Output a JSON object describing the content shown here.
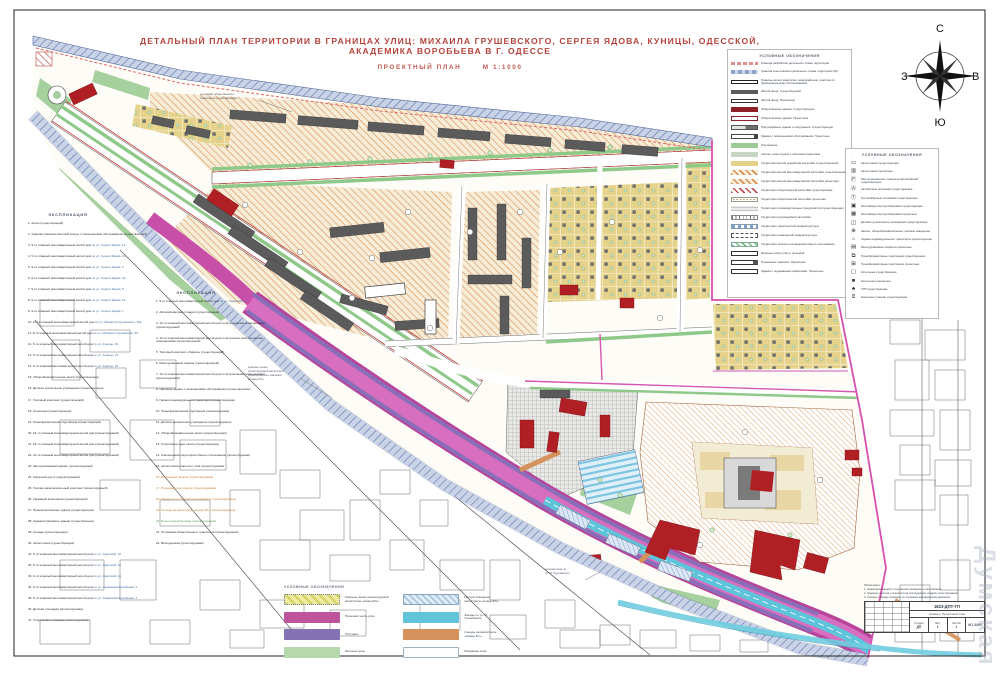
{
  "page": {
    "title": "ДЕТАЛЬНЫЙ ПЛАН ТЕРРИТОРИИ В ГРАНИЦАХ УЛИЦ: МИХАИЛА ГРУШЕВСКОГО, СЕРГЕЯ ЯДОВА, КУНИЦЫ, ОДЕССКОЙ, АКАДЕМИКА ВОРОБЬЕВА В Г. ОДЕССЕ",
    "subtitle": "ПРОЕКТНЫЙ ПЛАН",
    "scale": "М 1:1000",
    "watermark": "Думская"
  },
  "compass": {
    "north": "С",
    "south": "Ю",
    "west": "З",
    "east": "В"
  },
  "legend_main": {
    "header": "УСЛОВНЫЕ ОБОЗНАЧЕНИЯ",
    "items": [
      {
        "swatch": "sw-pinkline",
        "label": "Граница разработки детального плана территории"
      },
      {
        "swatch": "sw-blueband",
        "label": "Граница зоны влияния детального плана территории (М)"
      },
      {
        "swatch": "sw-outline-hatch",
        "label": "Границы жилых кварталов, микрорайонов, участков по функциональному использованию"
      },
      {
        "swatch": "sw-darkgray",
        "label": "Жилой фонд. Существующий"
      },
      {
        "swatch": "sw-whitebar",
        "label": "Жилой фонд. Проектный"
      },
      {
        "swatch": "sw-darkred",
        "label": "Общественные здания. Существующие"
      },
      {
        "swatch": "sw-darkred-outline",
        "label": "Общественные здания. Проектные"
      },
      {
        "swatch": "sw-combo",
        "label": "Приусадебные здания и сооружения. Существующие"
      },
      {
        "swatch": "sw-proj",
        "label": "Здания с помещениями обслуживания. Проектные"
      },
      {
        "swatch": "sw-green",
        "label": "Озеленение"
      },
      {
        "swatch": "sw-graygreen",
        "label": "Газоны, зоны отдыха с обычным покрытием"
      },
      {
        "swatch": "sw-khaki",
        "label": "Территория жилой усадебной застройки (существующая)"
      },
      {
        "swatch": "sw-orangehatch",
        "label": "Территория жилой многоквартирной застройки существующая"
      },
      {
        "swatch": "sw-orangehatch",
        "label": "Территория жилой многоквартирной застройки проектная"
      },
      {
        "swatch": "sw-redhatch",
        "label": "Территория общественной застройки существующая"
      },
      {
        "swatch": "sw-browndots",
        "label": "Территория общественной застройки проектная"
      },
      {
        "swatch": "sw-graygrid",
        "label": "Территория производственных предприятий (существующая)"
      },
      {
        "swatch": "sw-vlines",
        "label": "Территория приусадебной застройки"
      },
      {
        "swatch": "sw-bluedash",
        "label": "Территория транспортной инфраструктуры"
      },
      {
        "swatch": "sw-dashline",
        "label": "Территория инженерной инфраструктуры"
      },
      {
        "swatch": "sw-greendash",
        "label": "Территория зеленых насаждений общего пользования"
      },
      {
        "swatch": "sw-whitebar2",
        "label": "Красные линии улиц и проездов"
      },
      {
        "swatch": "sw-tail",
        "label": "Подземные паркинги. Проектные"
      },
      {
        "swatch": "sw-box",
        "label": "Здания с подземными паркингами. Проектные"
      }
    ]
  },
  "legend_objects": {
    "header": "УСЛОВНЫЕ ОБОЗНАЧЕНИЯ",
    "items": [
      {
        "icon": "▭",
        "label": "Автостоянки существующие"
      },
      {
        "icon": "▥",
        "label": "Автостоянки проектные"
      },
      {
        "icon": "Ⓟ",
        "label": "Места временного хранения автомобилей существующие"
      },
      {
        "icon": "Ⓐ",
        "label": "Автобусные остановки существующие"
      },
      {
        "icon": "Ⓣ",
        "label": "Троллейбусные остановки существующие"
      },
      {
        "icon": "▣",
        "label": "Контейнеры мусоросборников существующие"
      },
      {
        "icon": "▦",
        "label": "Контейнеры мусоросборников проектные"
      },
      {
        "icon": "◫",
        "label": "Детские дошкольные учреждения существующие"
      },
      {
        "icon": "⊕",
        "label": "Школы, общеобразовательные учебные заведения"
      },
      {
        "icon": "⌂",
        "label": "Гаражи индивидуального транспорта существующие"
      },
      {
        "icon": "▤",
        "label": "Многоуровневые паркинги проектные"
      },
      {
        "icon": "⧉",
        "label": "Трансформаторные подстанции существующие"
      },
      {
        "icon": "⊞",
        "label": "Трансформаторные подстанции проектные"
      },
      {
        "icon": "▢",
        "label": "Котельные существующие"
      },
      {
        "icon": "■",
        "label": "Котельные проектные"
      },
      {
        "icon": "♣",
        "label": "ГРП существующие"
      },
      {
        "icon": "⌸",
        "label": "Насосные станции существующие"
      }
    ]
  },
  "legend_roads": {
    "header": "УСЛОВНЫЕ ОБОЗНАЧЕНИЯ",
    "left": [
      {
        "swatch": "sw-road-yellow",
        "label": "Красные линии проектируемой магистрали «Север-Юг»"
      },
      {
        "swatch": "sw-road-magenta",
        "label": "Проезжая часть улиц"
      },
      {
        "swatch": "sw-road-purple",
        "label": "Тротуары"
      },
      {
        "swatch": "sw-road-green",
        "label": "Зеленые зоны"
      }
    ],
    "right": [
      {
        "swatch": "sw-road-bluehatch",
        "label": "Полоса отведения магистрали «Север-Юг»"
      },
      {
        "swatch": "sw-road-cyan",
        "label": "Заезды по ул. М. Грушевского"
      },
      {
        "swatch": "sw-road-orange",
        "label": "Съезды на магистраль «Север-Юг»"
      },
      {
        "swatch": "sw-road-white",
        "label": "Резервная зона"
      }
    ]
  },
  "explication1": {
    "header": "ЭКСПЛИКАЦИЯ",
    "items": [
      {
        "text": "1. Ангар (существующий)"
      },
      {
        "text": "2. Административно-бытовой корпус с помещениями обслуживания (существующий)"
      },
      {
        "text": "3. 9-ти этажный многоквартирный жилой дом",
        "ref": "по ул. Сергея Ядова, 1а"
      },
      {
        "text": "4. 5-ти этажный многоквартирный жилой дом",
        "ref": "по ул. Сергея Ядова, 1б"
      },
      {
        "text": "5. 9-ти этажный многоквартирный жилой дом",
        "ref": "по ул. Сергея Ядова, 3"
      },
      {
        "text": "6. 9-ти этажный многоквартирный жилой дом",
        "ref": "по ул. Сергея Ядова, 3а"
      },
      {
        "text": "7. 5-ти этажный многоквартирный жилой дом",
        "ref": "по ул. Сергея Ядова, 5"
      },
      {
        "text": "8. 9-ти этажный многоквартирный жилой дом",
        "ref": "по ул. Сергея Ядова, 5а"
      },
      {
        "text": "9. 9-ти этажный многоквартирный жилой дом",
        "ref": "по ул. Сергея Ядова, 7"
      },
      {
        "text": "10. 10-ти этажный многоквартирный жилой дом",
        "ref": "по ул. Михаила Грушевского, 39а"
      },
      {
        "text": "11. 9-ти этажный многоквартирный жилой дом",
        "ref": "по ул. Михаила Грушевского, 39"
      },
      {
        "text": "12. 5-ти этажный многоквартирный жилой дом",
        "ref": "по ул. Куницы, 19"
      },
      {
        "text": "13. 5-ти этажный многоквартирный жилой дом",
        "ref": "по ул. Куницы, 21"
      },
      {
        "text": "14. 9-ти этажный многоквартирный жилой дом",
        "ref": "по ул. Куницы, 23"
      },
      {
        "text": "15. Общеобразовательная школа (существующая)"
      },
      {
        "text": "16. Детское дошкольное учреждение (существующее)"
      },
      {
        "text": "17. Торговый комплекс (существующий)"
      },
      {
        "text": "18. Котельная (существующая)"
      },
      {
        "text": "19. Трансформаторная подстанция (существующая)"
      },
      {
        "text": "20. 16-ти этажный многоквартирный жилой дом (проектируемый)"
      },
      {
        "text": "21. 16-ти этажный многоквартирный жилой дом (проектируемый)"
      },
      {
        "text": "22. 10-ти этажный многоквартирный жилой дом (проектируемый)"
      },
      {
        "text": "23. Многоуровневый паркинг (проектируемый)"
      },
      {
        "text": "24. Офисный центр (проектируемый)"
      },
      {
        "text": "25. Торгово-развлекательный комплекс (проектируемый)"
      },
      {
        "text": "26. Гаражный кооператив (существующий)"
      },
      {
        "text": "27. Производственные здания (существующие)"
      },
      {
        "text": "28. Административное здание (существующее)"
      },
      {
        "text": "29. Склады (существующие)"
      },
      {
        "text": "30. Автостоянка (существующая)"
      },
      {
        "text": "31. 5-ти этажный многоквартирный жилой дом",
        "ref": "по ул. Одесской, 10"
      },
      {
        "text": "32. 5-ти этажный многоквартирный жилой дом",
        "ref": "по ул. Одесской, 12"
      },
      {
        "text": "33. 9-ти этажный многоквартирный жилой дом",
        "ref": "по ул. Одесской, 14"
      },
      {
        "text": "34. 9-ти этажный многоквартирный жилой дом",
        "ref": "по ул. Академика Воробьева, 5"
      },
      {
        "text": "35. 5-ти этажный многоквартирный жилой дом",
        "ref": "по ул. Академика Воробьева, 7"
      },
      {
        "text": "36. Детская площадка (проектируемая)"
      },
      {
        "text": "37. Спортивная площадка (проектируемая)"
      }
    ]
  },
  "explication2": {
    "header": "ЭКСПЛИКАЦИЯ",
    "items": [
      {
        "text": "1. 9-ти этажный многоквартирный жилой дом",
        "ref": "по ул. Одесской, 1"
      },
      {
        "text": "2. Автозаправочная станция (существующая)"
      },
      {
        "text": "3. 16-ти этажный многоквартирный жилой дом со встроенными помещениями (проектируемый)"
      },
      {
        "text": "4. 16-ти этажный многоквартирный жилой дом со встроенно-пристроенными помещениями (проектируемый)"
      },
      {
        "text": "5. Торговый комплекс «Таврия» (существующий)"
      },
      {
        "text": "6. Многоуровневый паркинг (проектируемый)"
      },
      {
        "text": "7. 16-ти этажный многоквартирный жилой дом со встроенными помещениями (проектируемый)"
      },
      {
        "text": "8. Офисное здание с помещениями обслуживания (проектируемое)"
      },
      {
        "text": "9. Гаражи индивидуального транспорта (существующие)"
      },
      {
        "text": "10. Трансформаторная подстанция (проектируемая)"
      },
      {
        "text": "11. Детское дошкольное учреждение (проектируемое)"
      },
      {
        "text": "12. Общеобразовательная школа (существующая)"
      },
      {
        "text": "13. Спортивное ядро школы (существующее)"
      },
      {
        "text": "14. Озелененная территория общего пользования (проектируемая)"
      },
      {
        "text": "15. Автостоянка открытого типа (проектируемая)"
      },
      {
        "text": "16. Подземный паркинг (проектируемый)",
        "color": "#c87a2e"
      },
      {
        "text": "17. Площадка для отдыха (проектируемая)",
        "color": "#c87a2e"
      },
      {
        "text": "18. Заезды по ул. Михаила Грушевского (проектируемые)",
        "color": "#c87a2e"
      },
      {
        "text": "19. Съезды на магистраль «Север-Юг» (проектируемые)",
        "color": "#c87a2e"
      },
      {
        "text": "20. Пешеходный бульвар (проектируемый)",
        "color": "#5a9e57"
      },
      {
        "text": "21. Остановка общественного транспорта (проектируемая)"
      },
      {
        "text": "22. Велодорожка (проектируемая)"
      }
    ]
  },
  "annotations": {
    "a1": [
      "остановка общественного",
      "транспорта (существующая)"
    ],
    "a2": [
      "красные линии",
      "проектируемой магистрали",
      "общегородского значения",
      "«Север-Юг»"
    ],
    "a3": [
      "зеленая зона по",
      "ул. М. Грушевского"
    ]
  },
  "title_block": {
    "notes": [
      "Примечания:",
      "1. Нумерация зданий и сооружений приведена в экспликации.",
      "2. Границы участков уточняются на последующих стадиях проектирования.",
      "3. Съезды и заезды показаны по основным направлениям движения."
    ],
    "doc_number": "1823-ДПТ-ГП",
    "sheet_title": "Схема 1. Проектный план",
    "stage_label": "Стадия",
    "stage": "ДП",
    "sheet_label": "Лист",
    "sheet": "1",
    "sheets_label": "Листов",
    "sheets": "1",
    "scale": "М 1:1000"
  }
}
